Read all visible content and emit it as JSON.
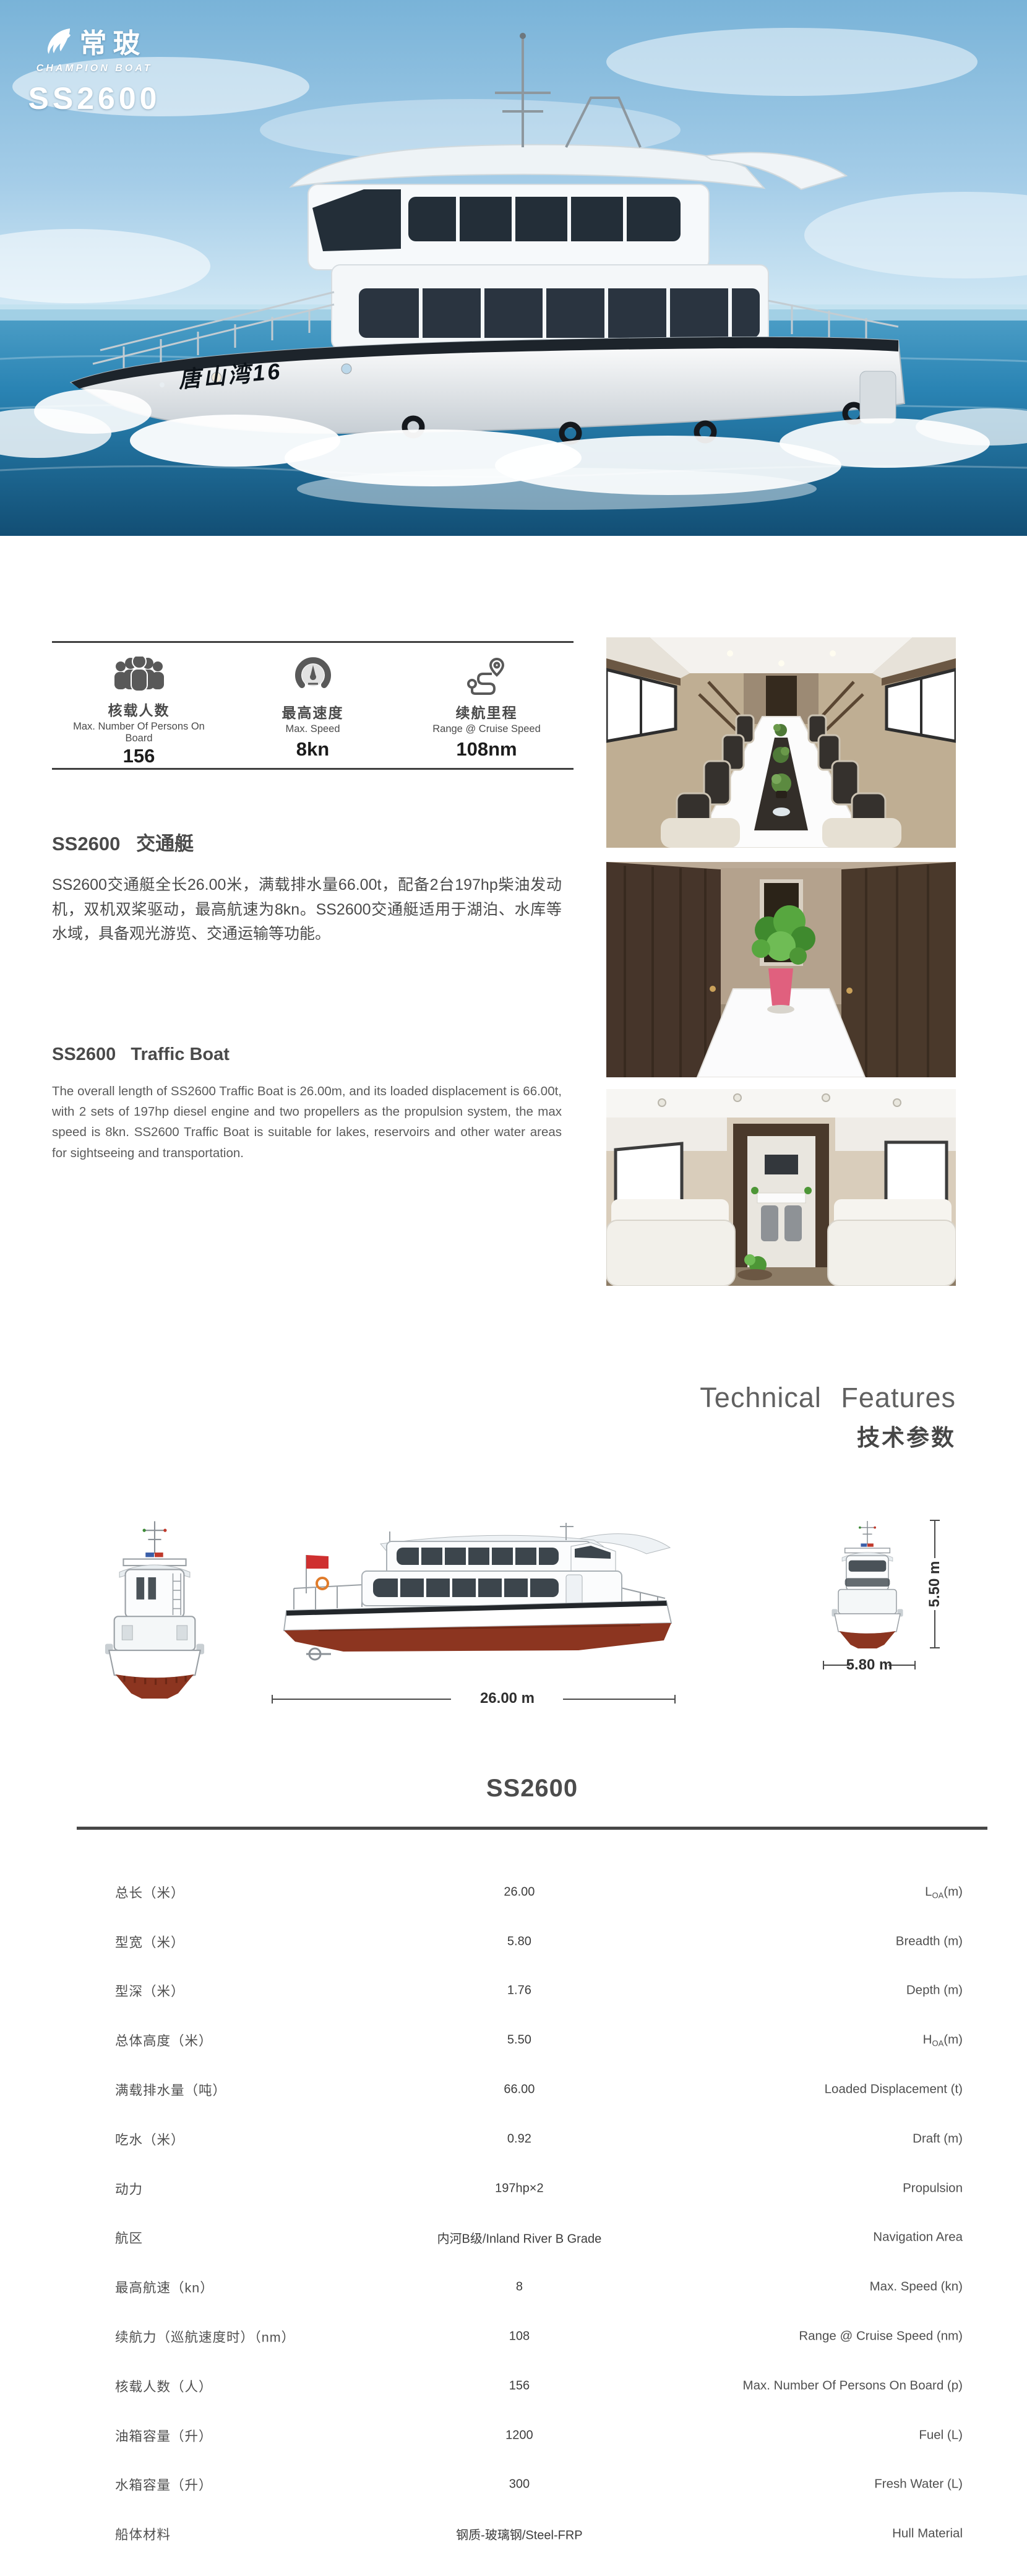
{
  "brand": {
    "logo_cn": "常玻",
    "logo_en": "CHAMPION BOAT",
    "model": "SS2600"
  },
  "hero": {
    "boat_name": "唐山湾16"
  },
  "quick_specs": {
    "items": [
      {
        "icon": "passengers-icon",
        "title_cn": "核载人数",
        "title_en": "Max. Number Of Persons On Board",
        "value": "156"
      },
      {
        "icon": "speedometer-icon",
        "title_cn": "最高速度",
        "title_en": "Max. Speed",
        "value": "8kn"
      },
      {
        "icon": "route-icon",
        "title_cn": "续航里程",
        "title_en": "Range @ Cruise Speed",
        "value": "108nm"
      }
    ]
  },
  "intro_cn": {
    "title": "SS2600   交通艇",
    "body": "SS2600交通艇全长26.00米，满载排水量66.00t，配备2台197hp柴油发动机，双机双桨驱动，最高航速为8kn。SS2600交通艇适用于湖泊、水库等水域，具备观光游览、交通运输等功能。"
  },
  "intro_en": {
    "title": "SS2600   Traffic Boat",
    "body": "The overall length of SS2600 Traffic Boat is 26.00m, and its loaded displacement is 66.00t, with 2 sets of 197hp diesel engine and two propellers as the propulsion system, the max speed is 8kn. SS2600 Traffic Boat is suitable for lakes, reservoirs and other water areas for sightseeing and transportation."
  },
  "tech_header": {
    "en": "Technical Features",
    "cn": "技术参数"
  },
  "drawings": {
    "loa_label": "26.00 m",
    "hoa_label": "5.50 m",
    "beam_label": "5.80 m"
  },
  "spec_table": {
    "title": "SS2600",
    "rows": [
      {
        "cn": "总长（米）",
        "value": "26.00",
        "en_pre": "L",
        "en_sub": "OA",
        "en_post": "(m)"
      },
      {
        "cn": "型宽（米）",
        "value": "5.80",
        "en_pre": "Breadth (m)",
        "en_sub": "",
        "en_post": ""
      },
      {
        "cn": "型深（米）",
        "value": "1.76",
        "en_pre": "Depth (m)",
        "en_sub": "",
        "en_post": ""
      },
      {
        "cn": "总体高度（米）",
        "value": "5.50",
        "en_pre": "H",
        "en_sub": "OA",
        "en_post": "(m)"
      },
      {
        "cn": "满载排水量（吨）",
        "value": "66.00",
        "en_pre": "Loaded Displacement (t)",
        "en_sub": "",
        "en_post": ""
      },
      {
        "cn": "吃水（米）",
        "value": "0.92",
        "en_pre": "Draft (m)",
        "en_sub": "",
        "en_post": ""
      },
      {
        "cn": "动力",
        "value": "197hp×2",
        "en_pre": "Propulsion",
        "en_sub": "",
        "en_post": ""
      },
      {
        "cn": "航区",
        "value": "内河B级/Inland River B Grade",
        "en_pre": "Navigation Area",
        "en_sub": "",
        "en_post": ""
      },
      {
        "cn": "最高航速（kn）",
        "value": "8",
        "en_pre": "Max. Speed (kn)",
        "en_sub": "",
        "en_post": ""
      },
      {
        "cn": "续航力（巡航速度时）（nm）",
        "value": "108",
        "en_pre": "Range @ Cruise Speed (nm)",
        "en_sub": "",
        "en_post": ""
      },
      {
        "cn": "核载人数（人）",
        "value": "156",
        "en_pre": "Max. Number Of Persons On Board (p)",
        "en_sub": "",
        "en_post": ""
      },
      {
        "cn": "油箱容量（升）",
        "value": "1200",
        "en_pre": "Fuel (L)",
        "en_sub": "",
        "en_post": ""
      },
      {
        "cn": "水箱容量（升）",
        "value": "300",
        "en_pre": "Fresh Water (L)",
        "en_sub": "",
        "en_post": ""
      },
      {
        "cn": "船体材料",
        "value": "钢质-玻璃钢/Steel-FRP",
        "en_pre": "Hull Material",
        "en_sub": "",
        "en_post": ""
      }
    ]
  },
  "colors": {
    "hull_red": "#8c3520",
    "rule_gray": "#474747",
    "text_gray": "#4f4f4f",
    "sea_blue": "#1d6f9f",
    "sky_blue": "#8fc1e0"
  },
  "chart_data": {
    "type": "table",
    "title": "SS2600",
    "columns": [
      "参数",
      "数值",
      "Parameter"
    ],
    "rows": [
      [
        "总长（米）",
        "26.00",
        "LOA(m)"
      ],
      [
        "型宽（米）",
        "5.80",
        "Breadth (m)"
      ],
      [
        "型深（米）",
        "1.76",
        "Depth (m)"
      ],
      [
        "总体高度（米）",
        "5.50",
        "HOA(m)"
      ],
      [
        "满载排水量（吨）",
        "66.00",
        "Loaded Displacement (t)"
      ],
      [
        "吃水（米）",
        "0.92",
        "Draft (m)"
      ],
      [
        "动力",
        "197hp×2",
        "Propulsion"
      ],
      [
        "航区",
        "内河B级/Inland River B Grade",
        "Navigation Area"
      ],
      [
        "最高航速（kn）",
        "8",
        "Max. Speed (kn)"
      ],
      [
        "续航力（巡航速度时）（nm）",
        "108",
        "Range @ Cruise Speed (nm)"
      ],
      [
        "核载人数（人）",
        "156",
        "Max. Number Of Persons On Board (p)"
      ],
      [
        "油箱容量（升）",
        "1200",
        "Fuel (L)"
      ],
      [
        "水箱容量（升）",
        "300",
        "Fresh Water (L)"
      ],
      [
        "船体材料",
        "钢质-玻璃钢/Steel-FRP",
        "Hull Material"
      ]
    ]
  }
}
